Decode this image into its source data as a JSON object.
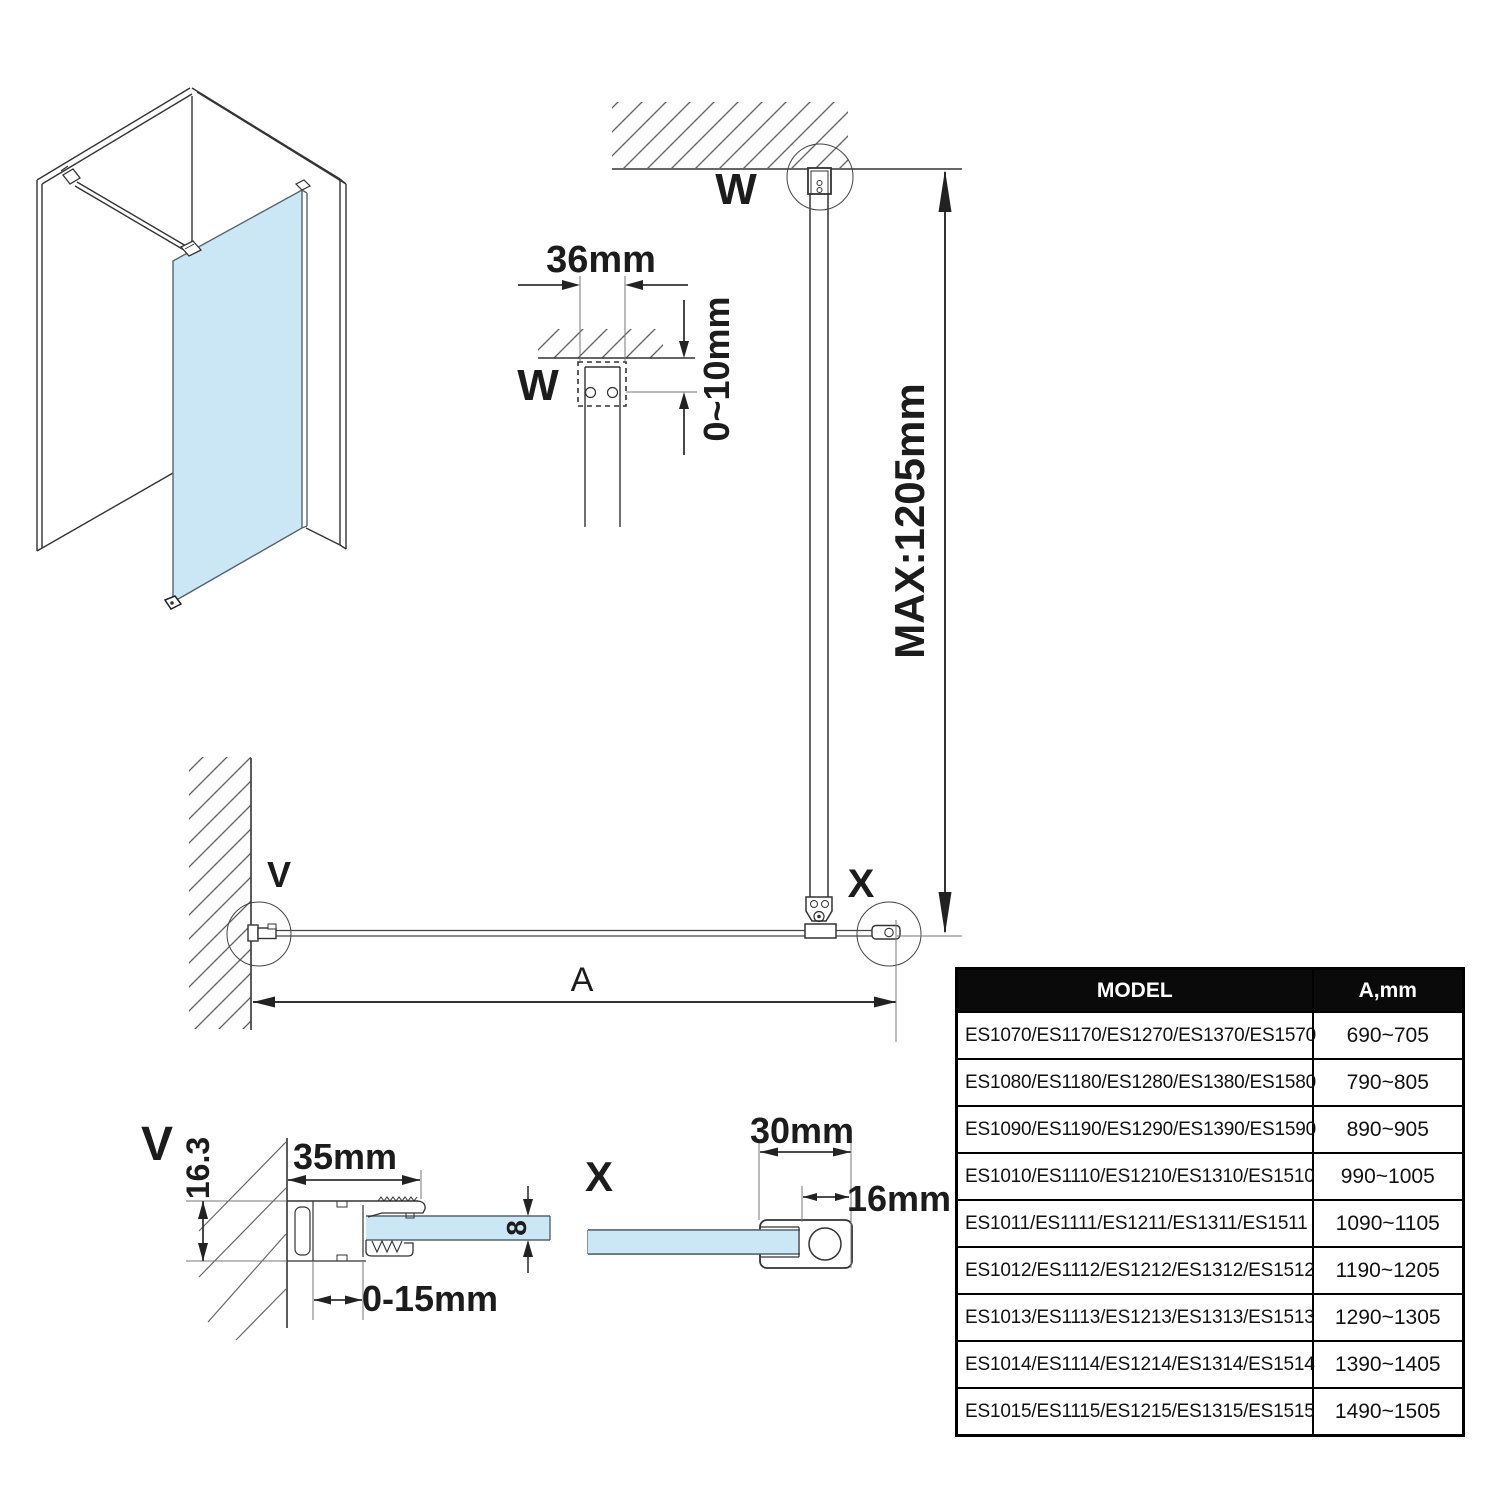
{
  "diagram": {
    "labels": {
      "w_main": "W",
      "w_detail": "W",
      "v_main": "V",
      "v_detail": "V",
      "x_main": "X",
      "x_detail": "X",
      "a": "A"
    },
    "dimensions": {
      "bar_bracket_width": "36mm",
      "ceiling_gap": "0~10mm",
      "bar_max_length": "MAX:1205mm",
      "wall_profile_height": "16.3",
      "wall_profile_width": "35mm",
      "glass_thickness": "8",
      "adjustment_range": "0-15mm",
      "foot_profile_width": "30mm",
      "foot_profile_depth": "16mm"
    },
    "colors": {
      "glass": "#CBE7F6",
      "line": "#333333"
    }
  },
  "table": {
    "headers": {
      "model": "MODEL",
      "a_mm": "A,mm"
    },
    "rows": [
      {
        "model": "ES1070/ES1170/ES1270/ES1370/ES1570",
        "a": "690~705"
      },
      {
        "model": "ES1080/ES1180/ES1280/ES1380/ES1580",
        "a": "790~805"
      },
      {
        "model": "ES1090/ES1190/ES1290/ES1390/ES1590",
        "a": "890~905"
      },
      {
        "model": "ES1010/ES1110/ES1210/ES1310/ES1510",
        "a": "990~1005"
      },
      {
        "model": "ES1011/ES1111/ES1211/ES1311/ES1511",
        "a": "1090~1105"
      },
      {
        "model": "ES1012/ES1112/ES1212/ES1312/ES1512",
        "a": "1190~1205"
      },
      {
        "model": "ES1013/ES1113/ES1213/ES1313/ES1513",
        "a": "1290~1305"
      },
      {
        "model": "ES1014/ES1114/ES1214/ES1314/ES1514",
        "a": "1390~1405"
      },
      {
        "model": "ES1015/ES1115/ES1215/ES1315/ES1515",
        "a": "1490~1505"
      }
    ]
  }
}
